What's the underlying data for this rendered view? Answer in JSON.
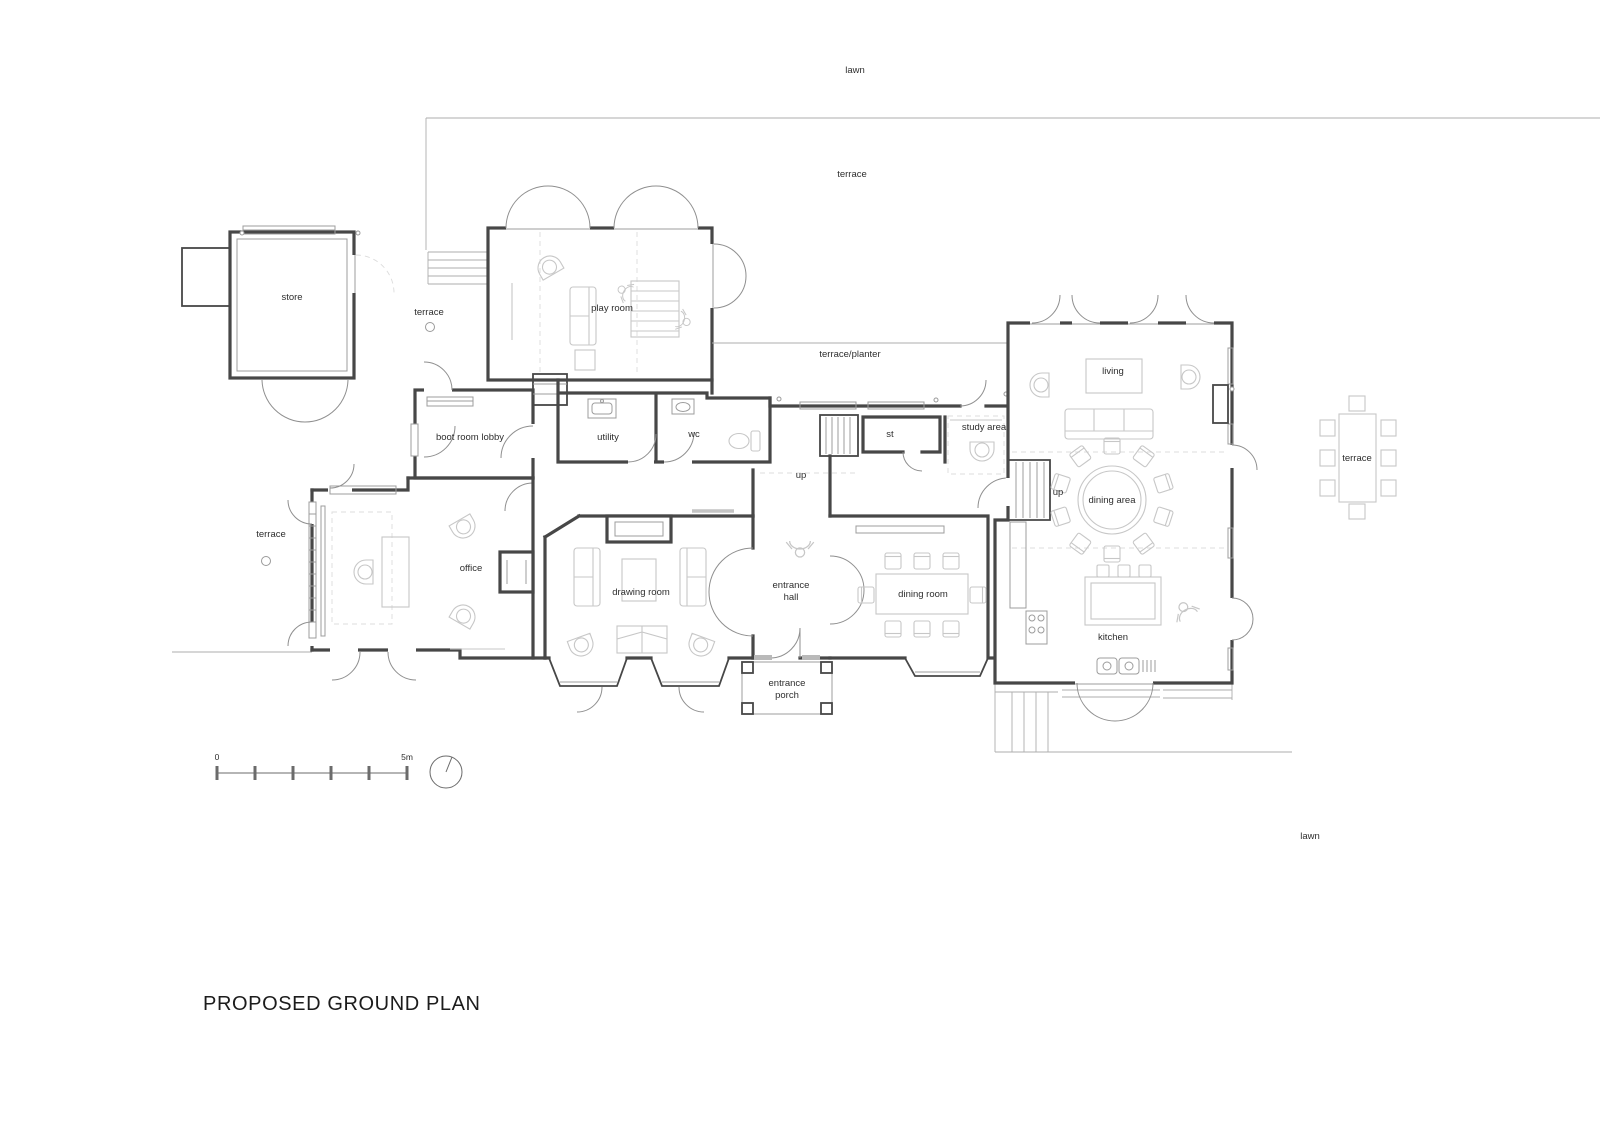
{
  "title": {
    "text": "PROPOSED GROUND PLAN"
  },
  "scale_bar": {
    "zero": "0",
    "five": "5m"
  },
  "north_arrow": {
    "icon": "north-arrow-icon"
  },
  "colors": {
    "wall": "#474747",
    "furniture": "#c7c7c7",
    "door_arc": "#8f8f8f",
    "window": "#9c9c9c",
    "site_line": "#adadad",
    "ink": "#2e2e2e"
  },
  "labels": [
    {
      "id": "lawn-top",
      "text": "lawn",
      "x": 855,
      "y": 73
    },
    {
      "id": "terrace-top",
      "text": "terrace",
      "x": 852,
      "y": 177
    },
    {
      "id": "store",
      "text": "store",
      "x": 292,
      "y": 300
    },
    {
      "id": "terrace-store",
      "text": "terrace",
      "x": 429,
      "y": 315
    },
    {
      "id": "play-room",
      "text": "play room",
      "x": 612,
      "y": 311
    },
    {
      "id": "terrace-planter",
      "text": "terrace/planter",
      "x": 850,
      "y": 357
    },
    {
      "id": "living",
      "text": "living",
      "x": 1113,
      "y": 374
    },
    {
      "id": "boot-room-lobby",
      "text": "boot room lobby",
      "x": 470,
      "y": 440
    },
    {
      "id": "utility",
      "text": "utility",
      "x": 608,
      "y": 440
    },
    {
      "id": "wc",
      "text": "wc",
      "x": 694,
      "y": 437
    },
    {
      "id": "st",
      "text": "st",
      "x": 890,
      "y": 437
    },
    {
      "id": "study-area",
      "text": "study area",
      "x": 984,
      "y": 430
    },
    {
      "id": "up-main",
      "text": "up",
      "x": 801,
      "y": 478
    },
    {
      "id": "up-kitchen",
      "text": "up",
      "x": 1058,
      "y": 495
    },
    {
      "id": "dining-area",
      "text": "dining area",
      "x": 1112,
      "y": 503
    },
    {
      "id": "terrace-right",
      "text": "terrace",
      "x": 1357,
      "y": 461
    },
    {
      "id": "terrace-left",
      "text": "terrace",
      "x": 271,
      "y": 537
    },
    {
      "id": "office",
      "text": "office",
      "x": 471,
      "y": 571
    },
    {
      "id": "drawing-room",
      "text": "drawing room",
      "x": 641,
      "y": 595
    },
    {
      "id": "entrance-hall-1",
      "text": "entrance",
      "x": 791,
      "y": 588
    },
    {
      "id": "entrance-hall-2",
      "text": "hall",
      "x": 791,
      "y": 600
    },
    {
      "id": "dining-room",
      "text": "dining room",
      "x": 923,
      "y": 597
    },
    {
      "id": "kitchen",
      "text": "kitchen",
      "x": 1113,
      "y": 640
    },
    {
      "id": "entrance-porch-1",
      "text": "entrance",
      "x": 787,
      "y": 686
    },
    {
      "id": "entrance-porch-2",
      "text": "porch",
      "x": 787,
      "y": 698
    },
    {
      "id": "lawn-bottom",
      "text": "lawn",
      "x": 1310,
      "y": 839
    }
  ]
}
